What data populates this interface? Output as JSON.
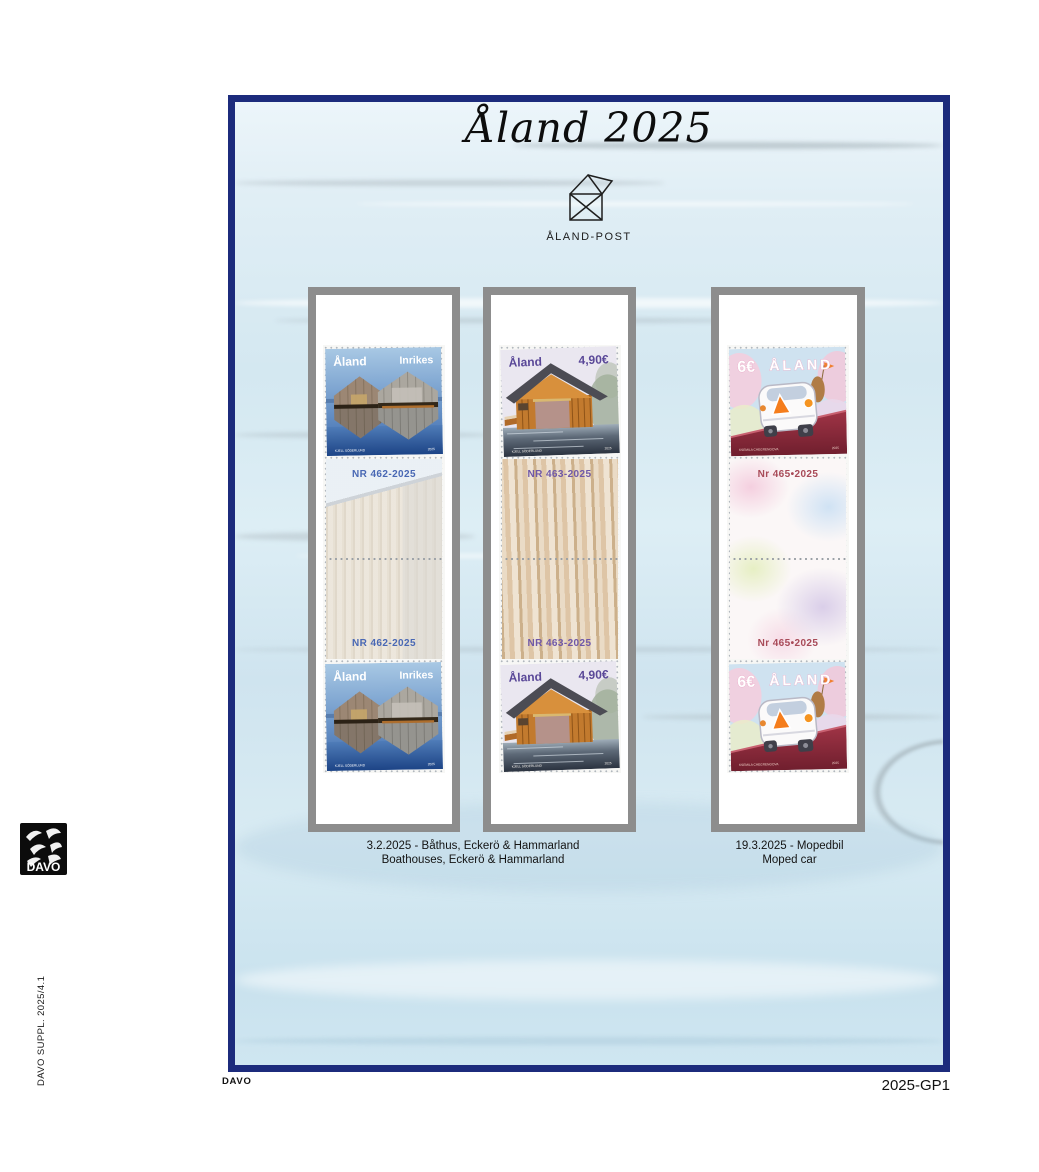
{
  "page": {
    "title": "Åland 2025",
    "code": "2025-GP1",
    "spine": "DAVO SUPPL. 2025/4.1",
    "brand": "DAVO",
    "footer_brand": "DAVO"
  },
  "post_logo": {
    "label": "ÅLAND-POST"
  },
  "strips": [
    {
      "stamp": {
        "country": "Åland",
        "denomination": "Inrikes",
        "artist": "KJELL SÖDERLUND",
        "year": "2025"
      },
      "gutter_top": "NR 462-2025",
      "gutter_bottom": "NR 462-2025"
    },
    {
      "stamp": {
        "country": "Åland",
        "denomination": "4,90€",
        "artist": "KJELL SÖDERLUND",
        "year": "2025"
      },
      "gutter_top": "NR 463-2025",
      "gutter_bottom": "NR 463-2025"
    },
    {
      "stamp": {
        "country": "ÅLAND",
        "denomination": "6€",
        "artist": "KSEMILA CHEGRENGOVA",
        "year": "2025"
      },
      "gutter_top": "Nr 465•2025",
      "gutter_bottom": "Nr 465•2025"
    }
  ],
  "captions": [
    {
      "line1": "3.2.2025 - Båthus, Eckerö & Hammarland",
      "line2": "Boathouses, Eckerö & Hammarland"
    },
    {
      "line1": "19.3.2025 - Mopedbil",
      "line2": "Moped car"
    }
  ],
  "colors": {
    "frame": "#1c2b7c",
    "strip_border": "#8d8d8d",
    "nr462": "#4968b4",
    "nr463": "#6f58a8",
    "nr465": "#a84a58"
  }
}
